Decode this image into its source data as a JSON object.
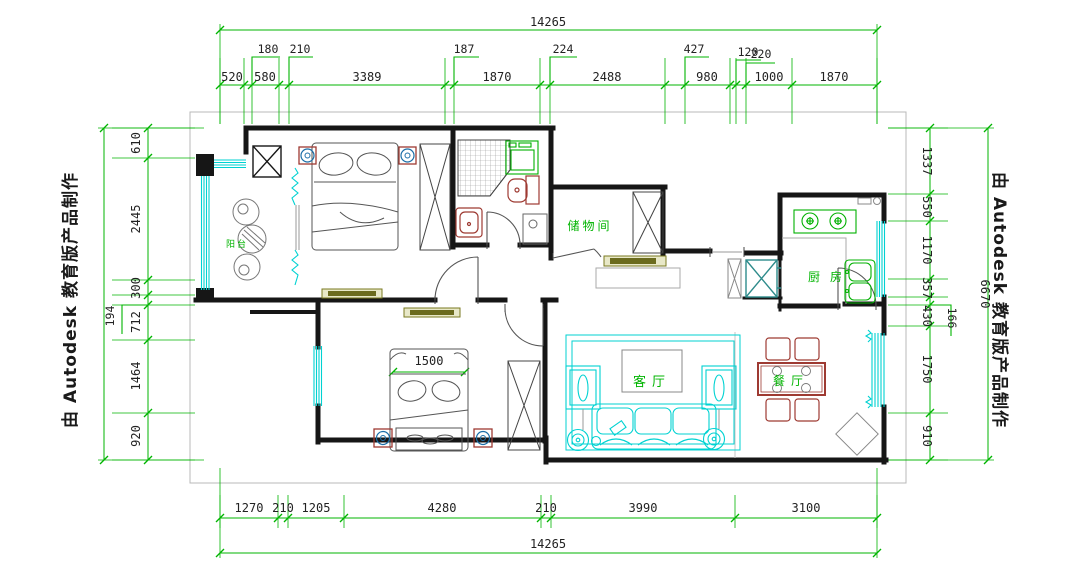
{
  "watermark": {
    "text": "由 Autodesk 教育版产品制作"
  },
  "dims": {
    "top": {
      "overall": "14265",
      "chain": [
        "520",
        "580",
        "3389",
        "1870",
        "2488",
        "980",
        "1000",
        "1870"
      ],
      "raised": [
        "180",
        "210",
        "187",
        "224",
        "427",
        "120",
        "220"
      ]
    },
    "bottom": {
      "overall": "14265",
      "chain": [
        "1270",
        "210",
        "1205",
        "4280",
        "210",
        "3990",
        "3100"
      ]
    },
    "left": {
      "chain": [
        "610",
        "2445",
        "300",
        "712",
        "1464",
        "920"
      ],
      "raised": [
        "194"
      ]
    },
    "right": {
      "overall": "6670",
      "chain": [
        "1337",
        "550",
        "1170",
        "357",
        "430",
        "1750",
        "910"
      ],
      "raised": [
        "166"
      ]
    }
  },
  "rooms": {
    "balcony": "阳台",
    "storage": "储物间",
    "kitchen": "厨房",
    "living": "客厅",
    "dining": "餐厅"
  },
  "bed_width": "1500",
  "colors": {
    "dimension_line": "#00b400",
    "window": "#00d2d2",
    "furniture_red": "#9e3a32",
    "fixture_green": "#00b000",
    "fridge_teal": "#2e8b8b",
    "speaker_blue": "#1b6ea8",
    "wall": "#161616",
    "cabinet_olive": "#7a7a20"
  }
}
